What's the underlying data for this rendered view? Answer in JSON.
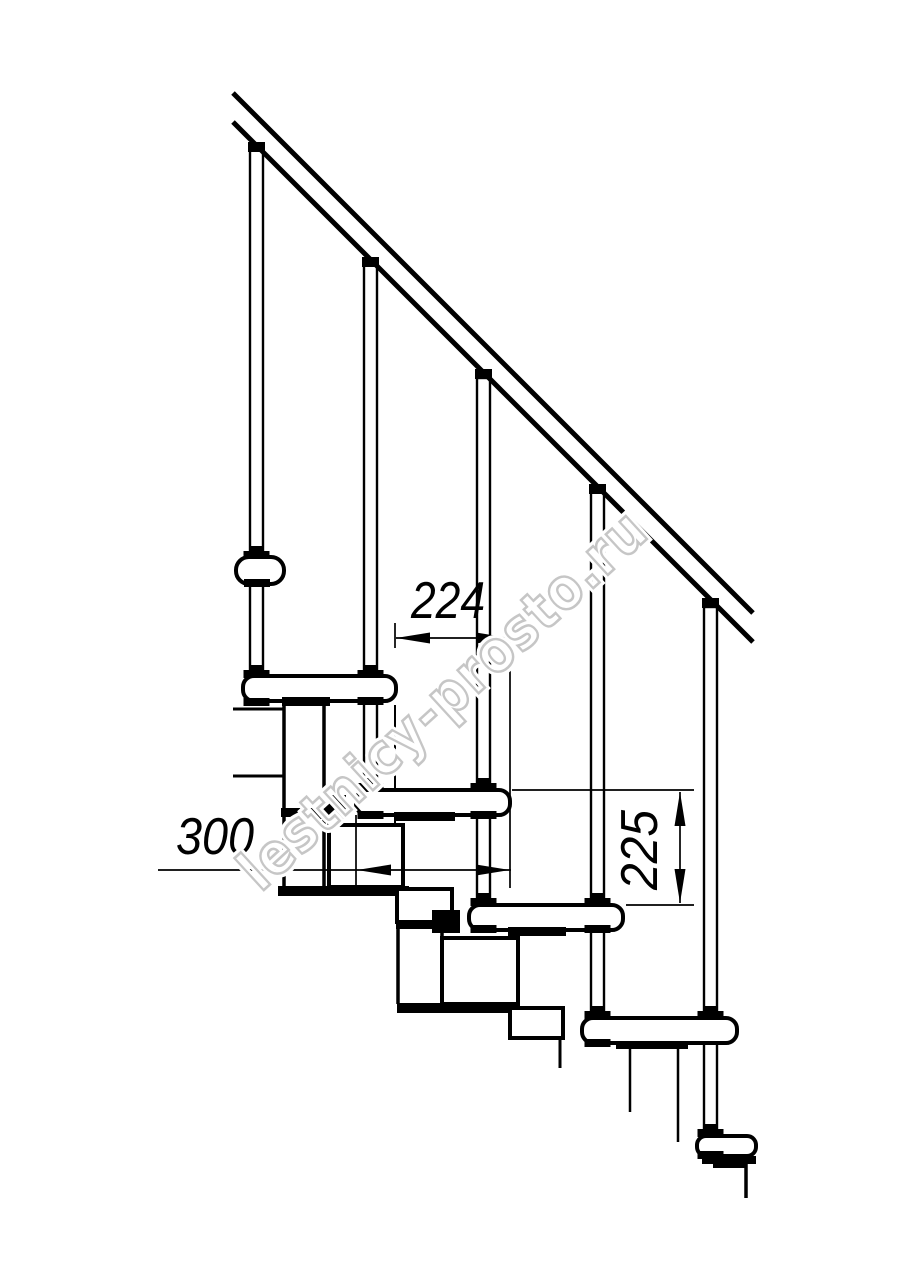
{
  "window": {
    "width": 914,
    "height": 1280,
    "background_color": "#ffffff",
    "ink_color": "#000000"
  },
  "drawing": {
    "kind": "staircase-side-elevation",
    "dimensions": {
      "run": {
        "label": "224"
      },
      "depth": {
        "label": "300"
      },
      "rise": {
        "label": "225"
      }
    },
    "watermark": {
      "text": "lestnicy-prosto.ru",
      "color": "#c6c6c6"
    }
  }
}
